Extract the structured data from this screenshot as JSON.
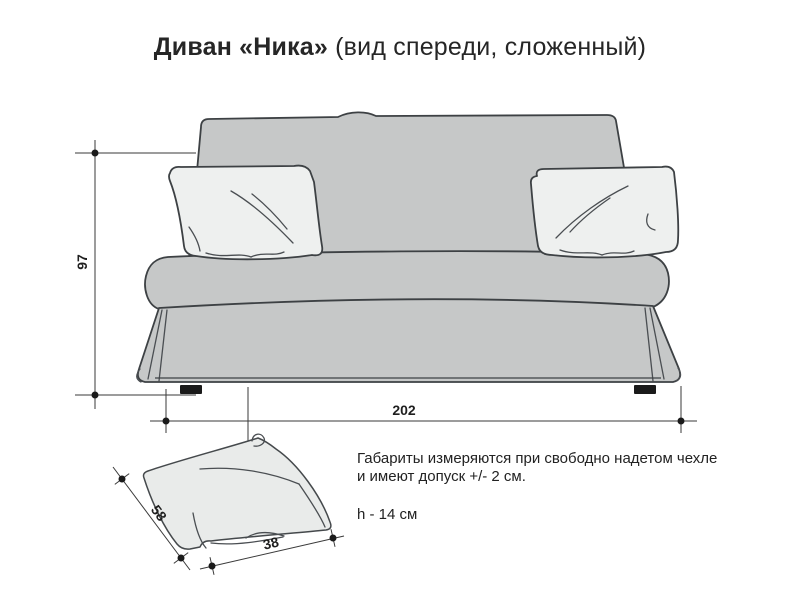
{
  "title": {
    "product": "Диван «Ника»",
    "view": " (вид спереди, сложенный)"
  },
  "dimensions": {
    "height_cm": "97",
    "width_cm": "202",
    "pillow_length_cm": "58",
    "pillow_width_cm": "38"
  },
  "notes": {
    "tolerance_line1": "Габариты измеряются при свободно надетом чехле",
    "tolerance_line2": "и имеют допуск +/- 2 см.",
    "pillow_height": "h - 14 см"
  },
  "colors": {
    "sofa_fill": "#c6c8c8",
    "pillow_fill": "#eef0ef",
    "detail_pillow_fill": "#e9ebea",
    "outline": "#3d4144",
    "dimension_line": "#3a3a3a",
    "text": "#262626",
    "background": "#ffffff"
  }
}
